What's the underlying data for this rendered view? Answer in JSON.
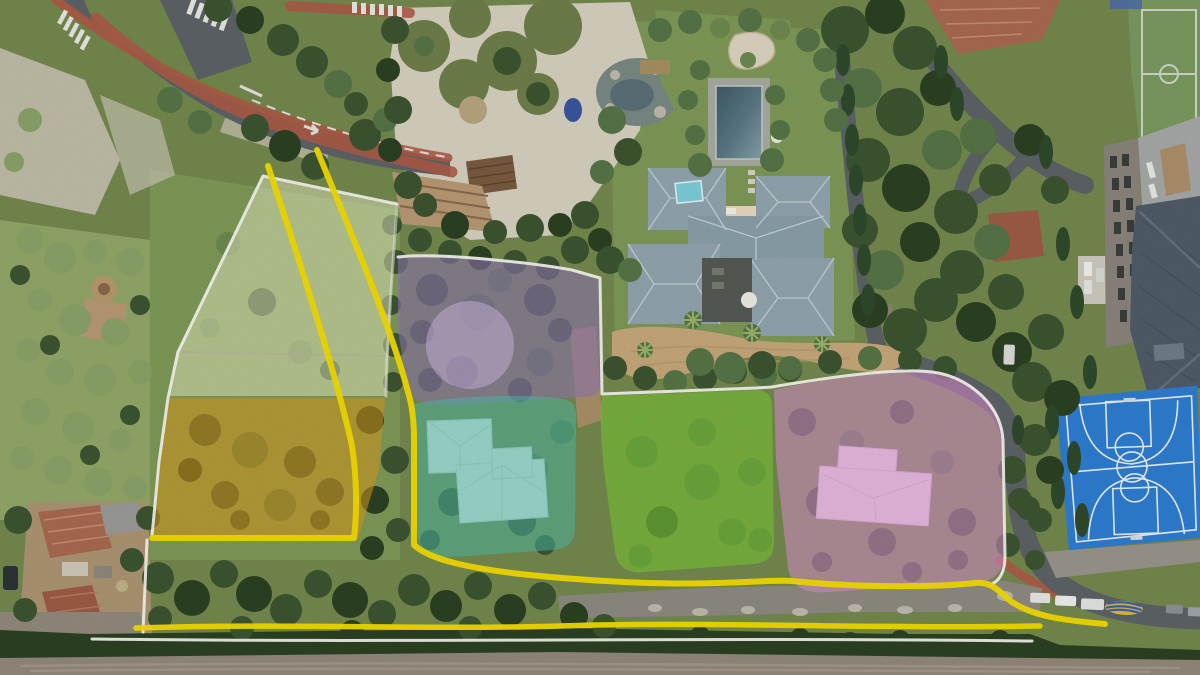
{
  "image": {
    "kind": "aerial-drone-photograph",
    "subject": "residential land plots marked with colored overlays and yellow/white boundary lines",
    "width_px": 1200,
    "height_px": 675
  },
  "palette": {
    "boundary_yellow": "#f6de00",
    "boundary_white": "#f8f8f2",
    "asphalt": "#5d6366",
    "sidewalk_red": "#b05a46",
    "gravel_path": "#d7d2c1",
    "dirt_track": "#93897b"
  },
  "plots": {
    "olive": {
      "label": "north-west plot",
      "color": "#e9edc4",
      "opacity": 0.5
    },
    "orange": {
      "label": "south-west plot",
      "color": "#dd9a1e",
      "opacity": 0.55
    },
    "purple": {
      "label": "north plot",
      "color": "#9176b3",
      "opacity": 0.6,
      "highlight": "#c9b5da",
      "highlight_opacity": 0.55
    },
    "teal": {
      "label": "central plot with house",
      "color": "#4cc0ab",
      "opacity": 0.5
    },
    "green": {
      "label": "central-east plot",
      "color": "#7ccd33",
      "opacity": 0.55
    },
    "pink": {
      "label": "east plot with house",
      "color": "#df8ed1",
      "opacity": 0.55
    }
  },
  "landmarks": {
    "villa": {
      "roof_color": "#92a5af",
      "skylight_color": "#7ccfdb"
    },
    "pool": {
      "color": "#4e6d79",
      "deck_color": "#a9aca2"
    },
    "basketball_court": {
      "color": "#2e7ed2",
      "line_color": "#e9f1f9"
    },
    "sports_field": {
      "color": "#7b9a60",
      "line_color": "#cfd8c8"
    },
    "school_building": {
      "roof_color": "#515c6a",
      "facade_color": "#8b857c"
    },
    "boat_cover": {
      "color": "#d8b84a",
      "stripe_color": "#3f63a8"
    }
  }
}
